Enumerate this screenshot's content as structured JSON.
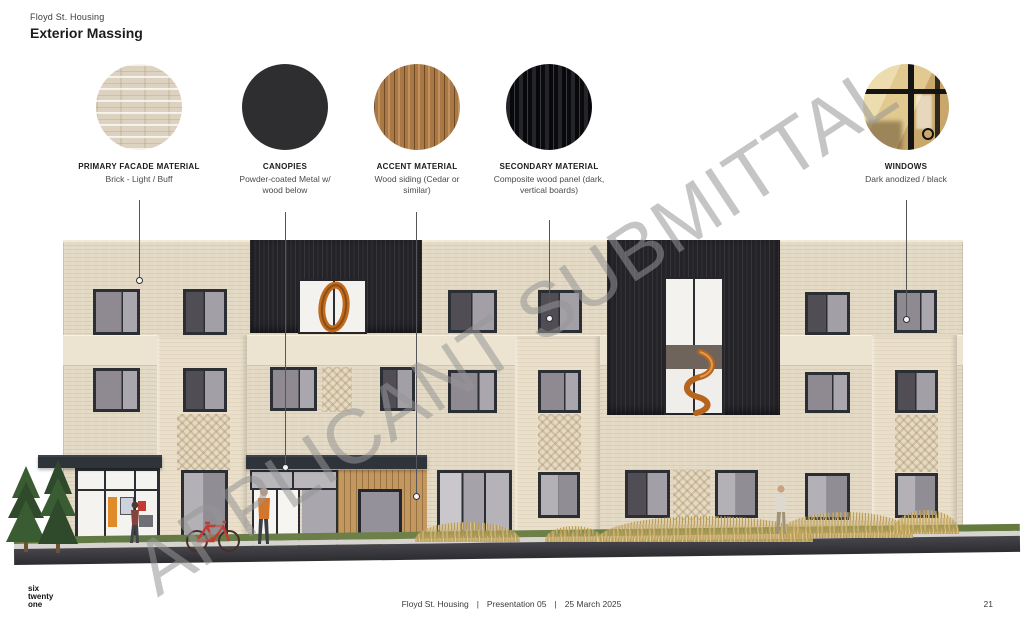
{
  "header": {
    "project": "Floyd St. Housing",
    "title": "Exterior Massing"
  },
  "watermark": "APPLICANT SUBMITTAL",
  "materials": [
    {
      "name": "PRIMARY FACADE MATERIAL",
      "desc": "Brick - Light / Buff",
      "swatch": "light-buff-brick-photo"
    },
    {
      "name": "CANOPIES",
      "desc": "Powder-coated Metal w/ wood below",
      "swatch": "dark-powder-coated-metal"
    },
    {
      "name": "ACCENT MATERIAL",
      "desc": "Wood siding (Cedar or similar)",
      "swatch": "cedar-wood-siding"
    },
    {
      "name": "SECONDARY MATERIAL",
      "desc": "Composite wood panel (dark, vertical boards)",
      "swatch": "dark-composite-wood-panel"
    },
    {
      "name": "WINDOWS",
      "desc": "Dark anodized / black",
      "swatch": "dark-anodized-window-photo"
    }
  ],
  "footer": {
    "logo_lines": [
      "six",
      "twenty",
      "one"
    ],
    "project": "Floyd St. Housing",
    "presentation": "Presentation 05",
    "date": "25 March 2025",
    "separator": "|",
    "page_number": "21"
  },
  "colors": {
    "accent_orange": "#c06a1e",
    "brick_beige": "#e3d9c4",
    "panel_dark": "#232328",
    "canopy_dark": "#2f333a",
    "cedar": "#c29760",
    "watermark_gray": "#969696"
  }
}
